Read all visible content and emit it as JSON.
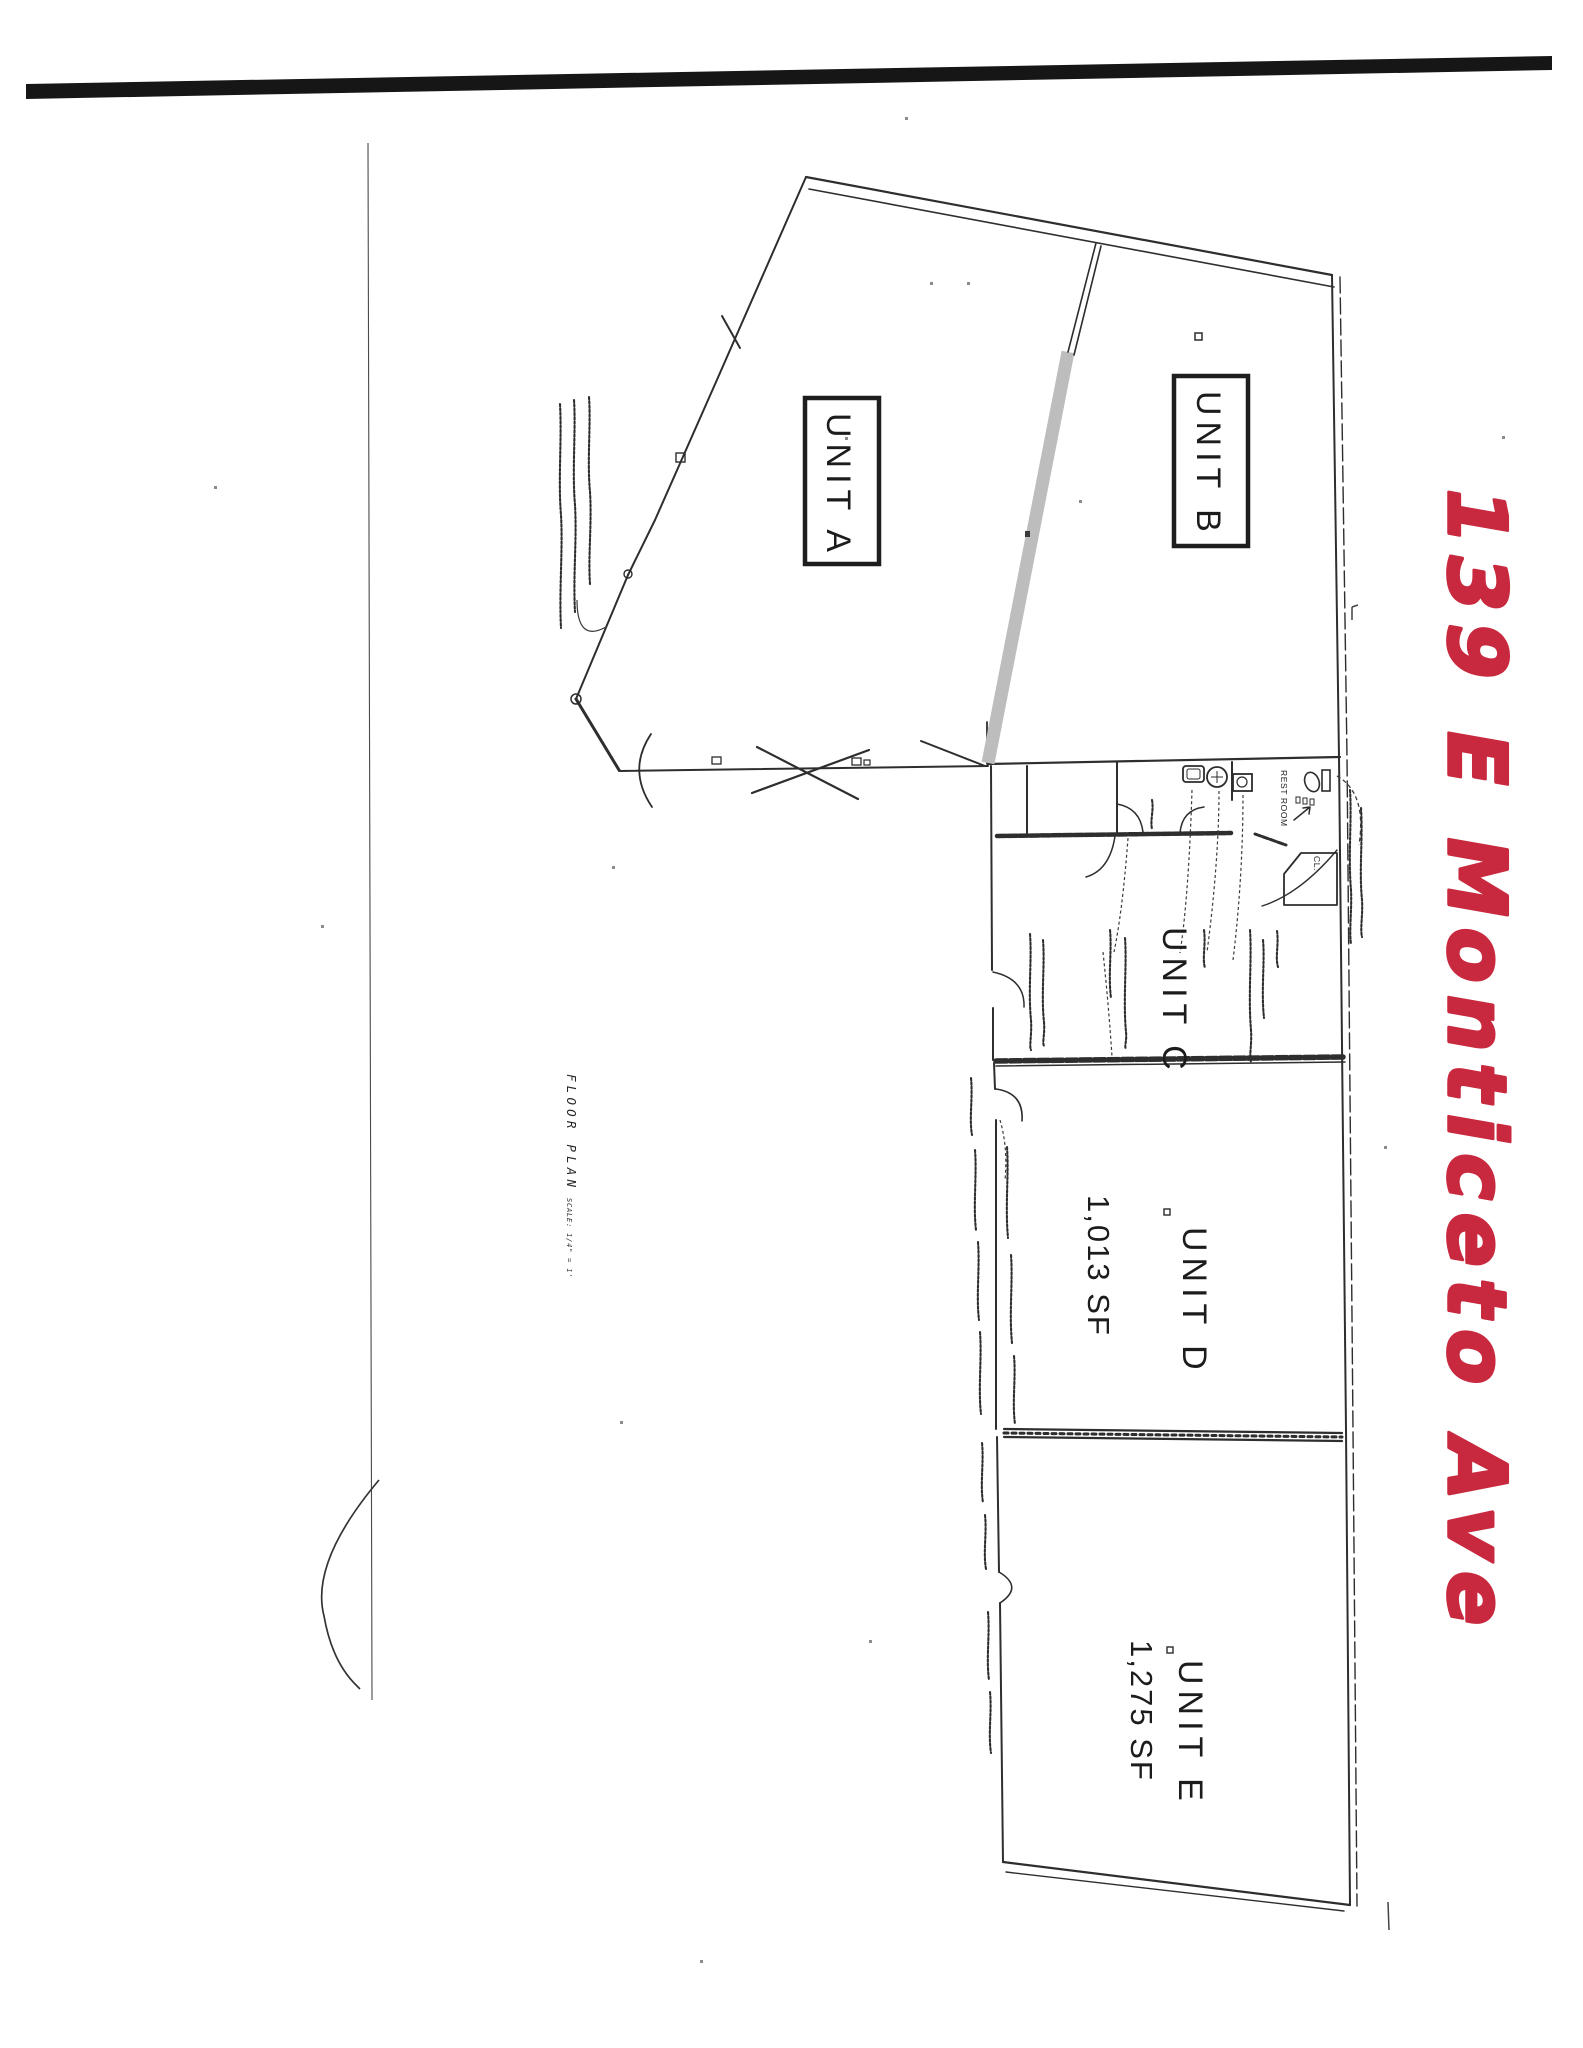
{
  "page": {
    "background": "#ffffff",
    "ink_color": "#2e2e2e",
    "scan_bar_color": "#161616"
  },
  "annotations": {
    "address": "139 E Monticeto Ave",
    "address_color": "#c8293f",
    "drawing_title": "FLOOR PLAN",
    "scale_note": "SCALE: 1/4\" = 1'",
    "restroom": "REST ROOM",
    "closet": "CL."
  },
  "units": [
    {
      "label": "UNIT A"
    },
    {
      "label": "UNIT B"
    },
    {
      "label": "UNIT C"
    },
    {
      "label": "UNIT D",
      "area": "1,013 SF"
    },
    {
      "label": "UNIT E",
      "area": "1,275 SF"
    }
  ]
}
